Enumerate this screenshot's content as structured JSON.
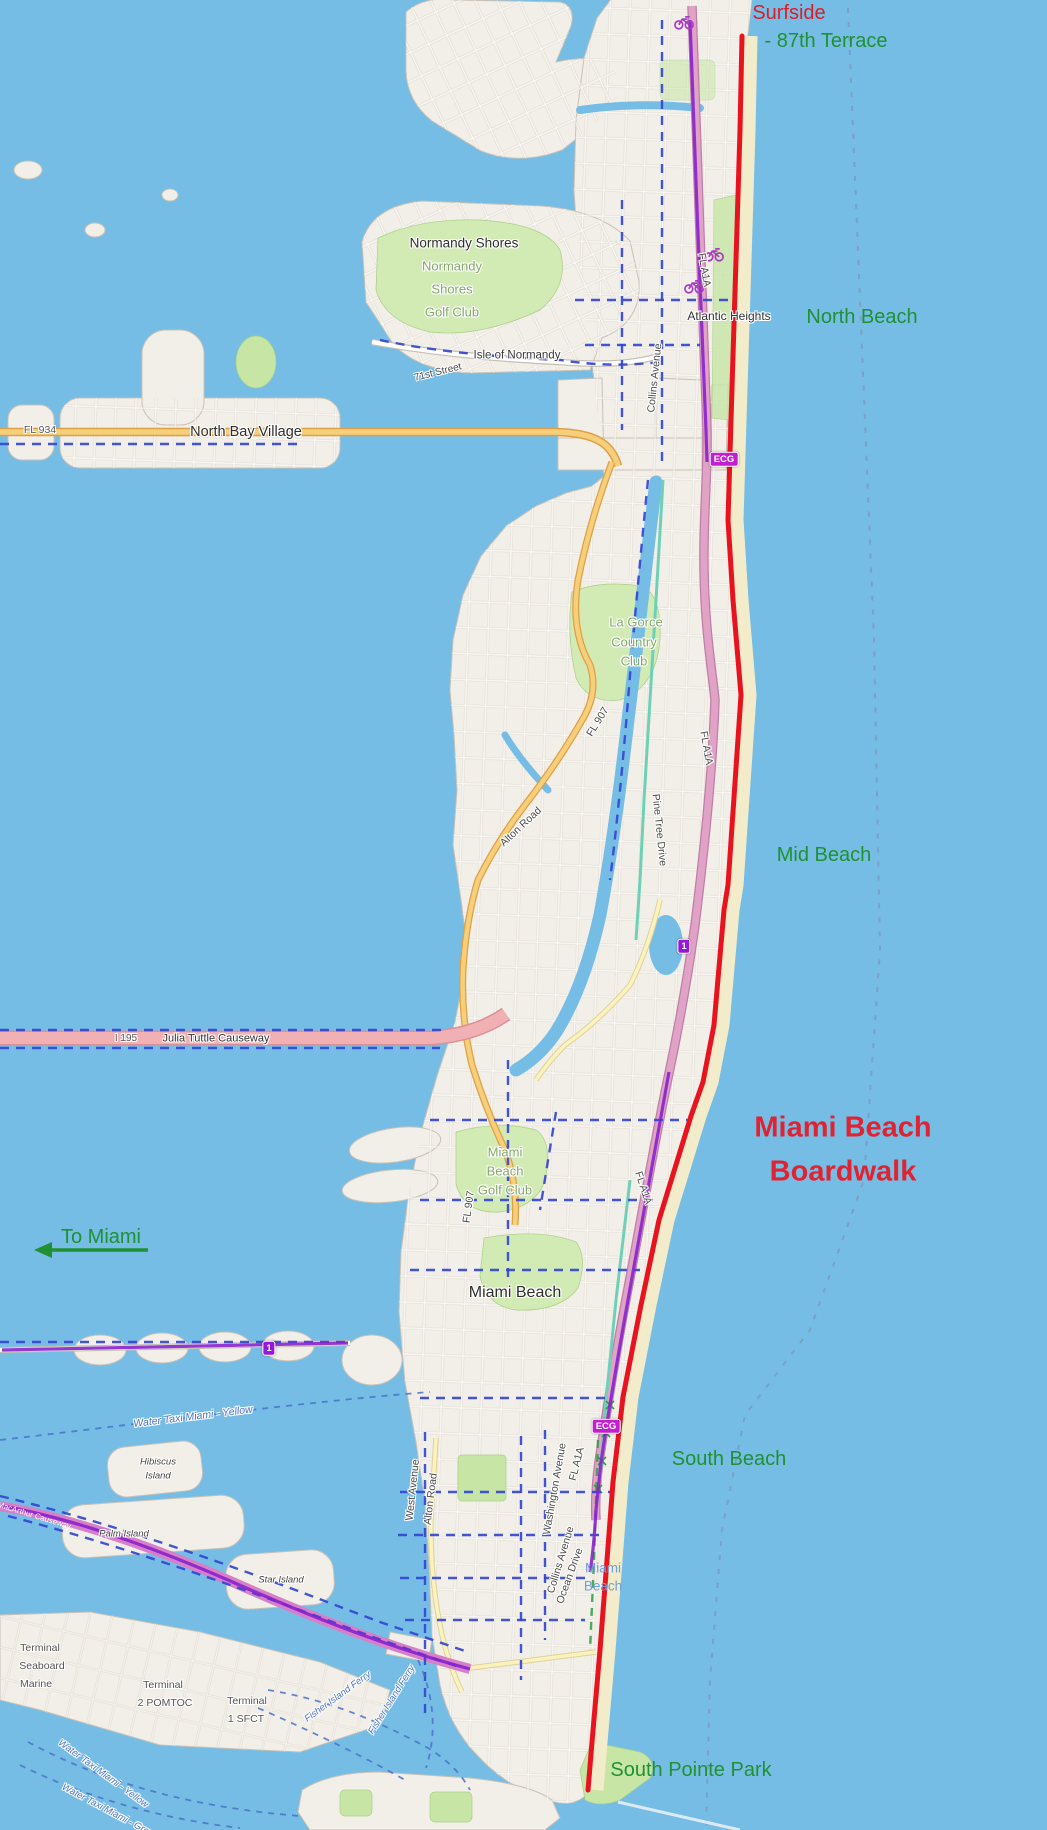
{
  "map": {
    "area": "Miami Beach, Florida",
    "colors": {
      "water": "#76bde6",
      "land": "#f2efe8",
      "land_stroke": "#c9c1b5",
      "park": "#c7e6a6",
      "golf": "#d2eab4",
      "sand": "#f3ecca",
      "route_red": "#e8131f",
      "route_purple": "#8822cc",
      "route_blue": "#3347d1",
      "route_teal": "#6fd0b8",
      "ferry_blue": "#4a72c8",
      "boundary": "#7d93b8",
      "road_yellow": "#f6cf7a",
      "road_yellow_casing": "#df9f45",
      "road_pink": "#e0a3c6",
      "road_pink_casing": "#c07da8",
      "motorway_pink": "#f0b0b4",
      "causeway_magenta": "#d77fc8",
      "annotation_green": "#1f9132",
      "annotation_red": "#da1e28",
      "boardwalk_red": "#e02330",
      "golf_label": "#84a86b",
      "badge_ecg": "#c21fd1",
      "badge_route1": "#9517d8"
    },
    "labels": [
      {
        "t": "Surfside",
        "x": 789,
        "y": 13,
        "s": 20,
        "c": "#da1e28",
        "h": false
      },
      {
        "t": "- 87th Terrace",
        "x": 826,
        "y": 41,
        "s": 20,
        "c": "#1f9132",
        "h": false
      },
      {
        "t": "North Beach",
        "x": 862,
        "y": 317,
        "s": 20,
        "c": "#1f9132",
        "h": false
      },
      {
        "t": "Mid Beach",
        "x": 824,
        "y": 855,
        "s": 20,
        "c": "#1f9132",
        "h": false
      },
      {
        "t": "Miami Beach",
        "x": 843,
        "y": 1128,
        "s": 29,
        "c": "#e02330",
        "b": true,
        "h": false
      },
      {
        "t": "Boardwalk",
        "x": 843,
        "y": 1172,
        "s": 29,
        "c": "#e02330",
        "b": true,
        "h": false
      },
      {
        "t": "To Miami",
        "x": 101,
        "y": 1237,
        "s": 20,
        "c": "#1f9132",
        "h": false
      },
      {
        "t": "South Beach",
        "x": 729,
        "y": 1459,
        "s": 20,
        "c": "#1f9132",
        "h": false
      },
      {
        "t": "South Pointe Park",
        "x": 691,
        "y": 1770,
        "s": 20,
        "c": "#1f9132",
        "h": false
      },
      {
        "t": "Normandy Shores",
        "x": 464,
        "y": 243,
        "s": 13.5,
        "c": "#2f2f2f"
      },
      {
        "t": "Normandy",
        "x": 452,
        "y": 266,
        "s": 13,
        "c": "#84a86b"
      },
      {
        "t": "Shores",
        "x": 452,
        "y": 289,
        "s": 13,
        "c": "#84a86b"
      },
      {
        "t": "Golf Club",
        "x": 452,
        "y": 312,
        "s": 13,
        "c": "#84a86b"
      },
      {
        "t": "Isle of Normandy",
        "x": 517,
        "y": 356,
        "s": 11.5,
        "c": "#3a3a3a"
      },
      {
        "t": "71st Street",
        "x": 438,
        "y": 373,
        "s": 10,
        "c": "#4a4a4a",
        "r": -14
      },
      {
        "t": "Collins Avenue",
        "x": 655,
        "y": 378,
        "s": 10.5,
        "c": "#4a4a4a",
        "r": -84
      },
      {
        "t": "FL A1A",
        "x": 704,
        "y": 270,
        "s": 10.5,
        "c": "#4a4a4a",
        "r": 80
      },
      {
        "t": "North Bay Village",
        "x": 246,
        "y": 432,
        "s": 14.5,
        "c": "#2f2f2f"
      },
      {
        "t": "FL 934",
        "x": 40,
        "y": 430,
        "s": 10.5,
        "c": "#5a5a5a"
      },
      {
        "t": "Atlantic Heights",
        "x": 729,
        "y": 316,
        "s": 12,
        "c": "#333333"
      },
      {
        "t": "La Gorce",
        "x": 636,
        "y": 622,
        "s": 13,
        "c": "#84a86b"
      },
      {
        "t": "Country",
        "x": 634,
        "y": 642,
        "s": 13,
        "c": "#84a86b"
      },
      {
        "t": "Club",
        "x": 634,
        "y": 661,
        "s": 13,
        "c": "#84a86b"
      },
      {
        "t": "FL A1A",
        "x": 706,
        "y": 748,
        "s": 10.5,
        "c": "#4a4a4a",
        "r": 80
      },
      {
        "t": "FL 907",
        "x": 598,
        "y": 722,
        "s": 10.5,
        "c": "#4a4a4a",
        "r": -58
      },
      {
        "t": "Alton Road",
        "x": 521,
        "y": 827,
        "s": 10.5,
        "c": "#4a4a4a",
        "r": -43
      },
      {
        "t": "Pine Tree Drive",
        "x": 659,
        "y": 830,
        "s": 10.5,
        "c": "#4a4a4a",
        "r": 84
      },
      {
        "t": "I 195",
        "x": 126,
        "y": 1039,
        "s": 10,
        "c": "#5a5a5a"
      },
      {
        "t": "Julia Tuttle Causeway",
        "x": 216,
        "y": 1039,
        "s": 11,
        "c": "#333333"
      },
      {
        "t": "Miami",
        "x": 505,
        "y": 1152,
        "s": 13,
        "c": "#84a86b"
      },
      {
        "t": "Beach",
        "x": 505,
        "y": 1171,
        "s": 13,
        "c": "#84a86b"
      },
      {
        "t": "Golf Club",
        "x": 505,
        "y": 1190,
        "s": 13,
        "c": "#84a86b"
      },
      {
        "t": "FL A1A",
        "x": 643,
        "y": 1188,
        "s": 10.5,
        "c": "#4a4a4a",
        "r": 72
      },
      {
        "t": "FL 907",
        "x": 469,
        "y": 1207,
        "s": 10.5,
        "c": "#4a4a4a",
        "r": -82
      },
      {
        "t": "Miami Beach",
        "x": 515,
        "y": 1293,
        "s": 16,
        "c": "#2f2f2f"
      },
      {
        "t": "Water Taxi Miami - Yellow",
        "x": 193,
        "y": 1417,
        "s": 10.5,
        "c": "#4a72c8",
        "i": true,
        "r": -7
      },
      {
        "t": "Hibiscus",
        "x": 158,
        "y": 1462,
        "s": 9.5,
        "c": "#444444",
        "i": true
      },
      {
        "t": "Island",
        "x": 158,
        "y": 1476,
        "s": 9.5,
        "c": "#444444",
        "i": true
      },
      {
        "t": "Palm Island",
        "x": 124,
        "y": 1534,
        "s": 9.5,
        "c": "#444444",
        "i": true
      },
      {
        "t": "Star Island",
        "x": 281,
        "y": 1580,
        "s": 9.5,
        "c": "#444444",
        "i": true
      },
      {
        "t": "MacArthur Causeway",
        "x": 34,
        "y": 1516,
        "s": 8,
        "c": "#ffffff",
        "r": 17,
        "h": false
      },
      {
        "t": "West Avenue",
        "x": 413,
        "y": 1490,
        "s": 10.5,
        "c": "#4a4a4a",
        "r": -84
      },
      {
        "t": "Alton Road",
        "x": 431,
        "y": 1499,
        "s": 10.5,
        "c": "#4a4a4a",
        "r": -83
      },
      {
        "t": "Washington Avenue",
        "x": 555,
        "y": 1489,
        "s": 10.5,
        "c": "#4a4a4a",
        "r": -80
      },
      {
        "t": "FL A1A",
        "x": 577,
        "y": 1464,
        "s": 10.5,
        "c": "#4a4a4a",
        "r": -76
      },
      {
        "t": "Collins Avenue",
        "x": 561,
        "y": 1560,
        "s": 10.5,
        "c": "#4a4a4a",
        "r": -73
      },
      {
        "t": "Ocean Drive",
        "x": 570,
        "y": 1576,
        "s": 10.5,
        "c": "#4a4a4a",
        "r": -70
      },
      {
        "t": "Miami",
        "x": 603,
        "y": 1568,
        "s": 13.5,
        "c": "#6f9fd8",
        "h": false
      },
      {
        "t": "Beach",
        "x": 603,
        "y": 1586,
        "s": 13.5,
        "c": "#6f9fd8",
        "h": false
      },
      {
        "t": "Terminal",
        "x": 40,
        "y": 1648,
        "s": 10.5,
        "c": "#555555"
      },
      {
        "t": "Seaboard",
        "x": 42,
        "y": 1666,
        "s": 10.5,
        "c": "#555555"
      },
      {
        "t": "Marine",
        "x": 36,
        "y": 1684,
        "s": 10.5,
        "c": "#555555"
      },
      {
        "t": "Terminal",
        "x": 163,
        "y": 1685,
        "s": 10.5,
        "c": "#555555"
      },
      {
        "t": "2 POMTOC",
        "x": 165,
        "y": 1703,
        "s": 10.5,
        "c": "#555555"
      },
      {
        "t": "Terminal",
        "x": 247,
        "y": 1701,
        "s": 10.5,
        "c": "#555555"
      },
      {
        "t": "1 SFCT",
        "x": 246,
        "y": 1719,
        "s": 10.5,
        "c": "#555555"
      },
      {
        "t": "Fisher Island Ferry",
        "x": 338,
        "y": 1697,
        "s": 9.5,
        "c": "#4a72c8",
        "i": true,
        "r": -36
      },
      {
        "t": "Fisher Island Ferry",
        "x": 392,
        "y": 1700,
        "s": 9.5,
        "c": "#4a72c8",
        "i": true,
        "r": -58
      },
      {
        "t": "Water Taxi Miami - Yellow",
        "x": 103,
        "y": 1774,
        "s": 9.5,
        "c": "#4a72c8",
        "i": true,
        "r": 36
      },
      {
        "t": "Water Taxi Miami - Green",
        "x": 110,
        "y": 1812,
        "s": 9.5,
        "c": "#4a72c8",
        "i": true,
        "r": 28
      }
    ],
    "badges": [
      {
        "t": "ECG",
        "x": 724,
        "y": 459,
        "bg": "#c21fd1"
      },
      {
        "t": "ECG",
        "x": 606,
        "y": 1426,
        "bg": "#c21fd1"
      },
      {
        "t": "1",
        "x": 684,
        "y": 946,
        "bg": "#9517d8"
      },
      {
        "t": "1",
        "x": 269,
        "y": 1348,
        "bg": "#9517d8"
      }
    ],
    "icons": [
      {
        "n": "bicycle",
        "x": 684,
        "y": 22
      },
      {
        "n": "bicycle",
        "x": 714,
        "y": 254
      },
      {
        "n": "bicycle",
        "x": 694,
        "y": 286
      }
    ],
    "route": {
      "name": "Miami Beach Boardwalk",
      "from": "Surfside - 87th Terrace",
      "to": "South Pointe Park"
    }
  }
}
